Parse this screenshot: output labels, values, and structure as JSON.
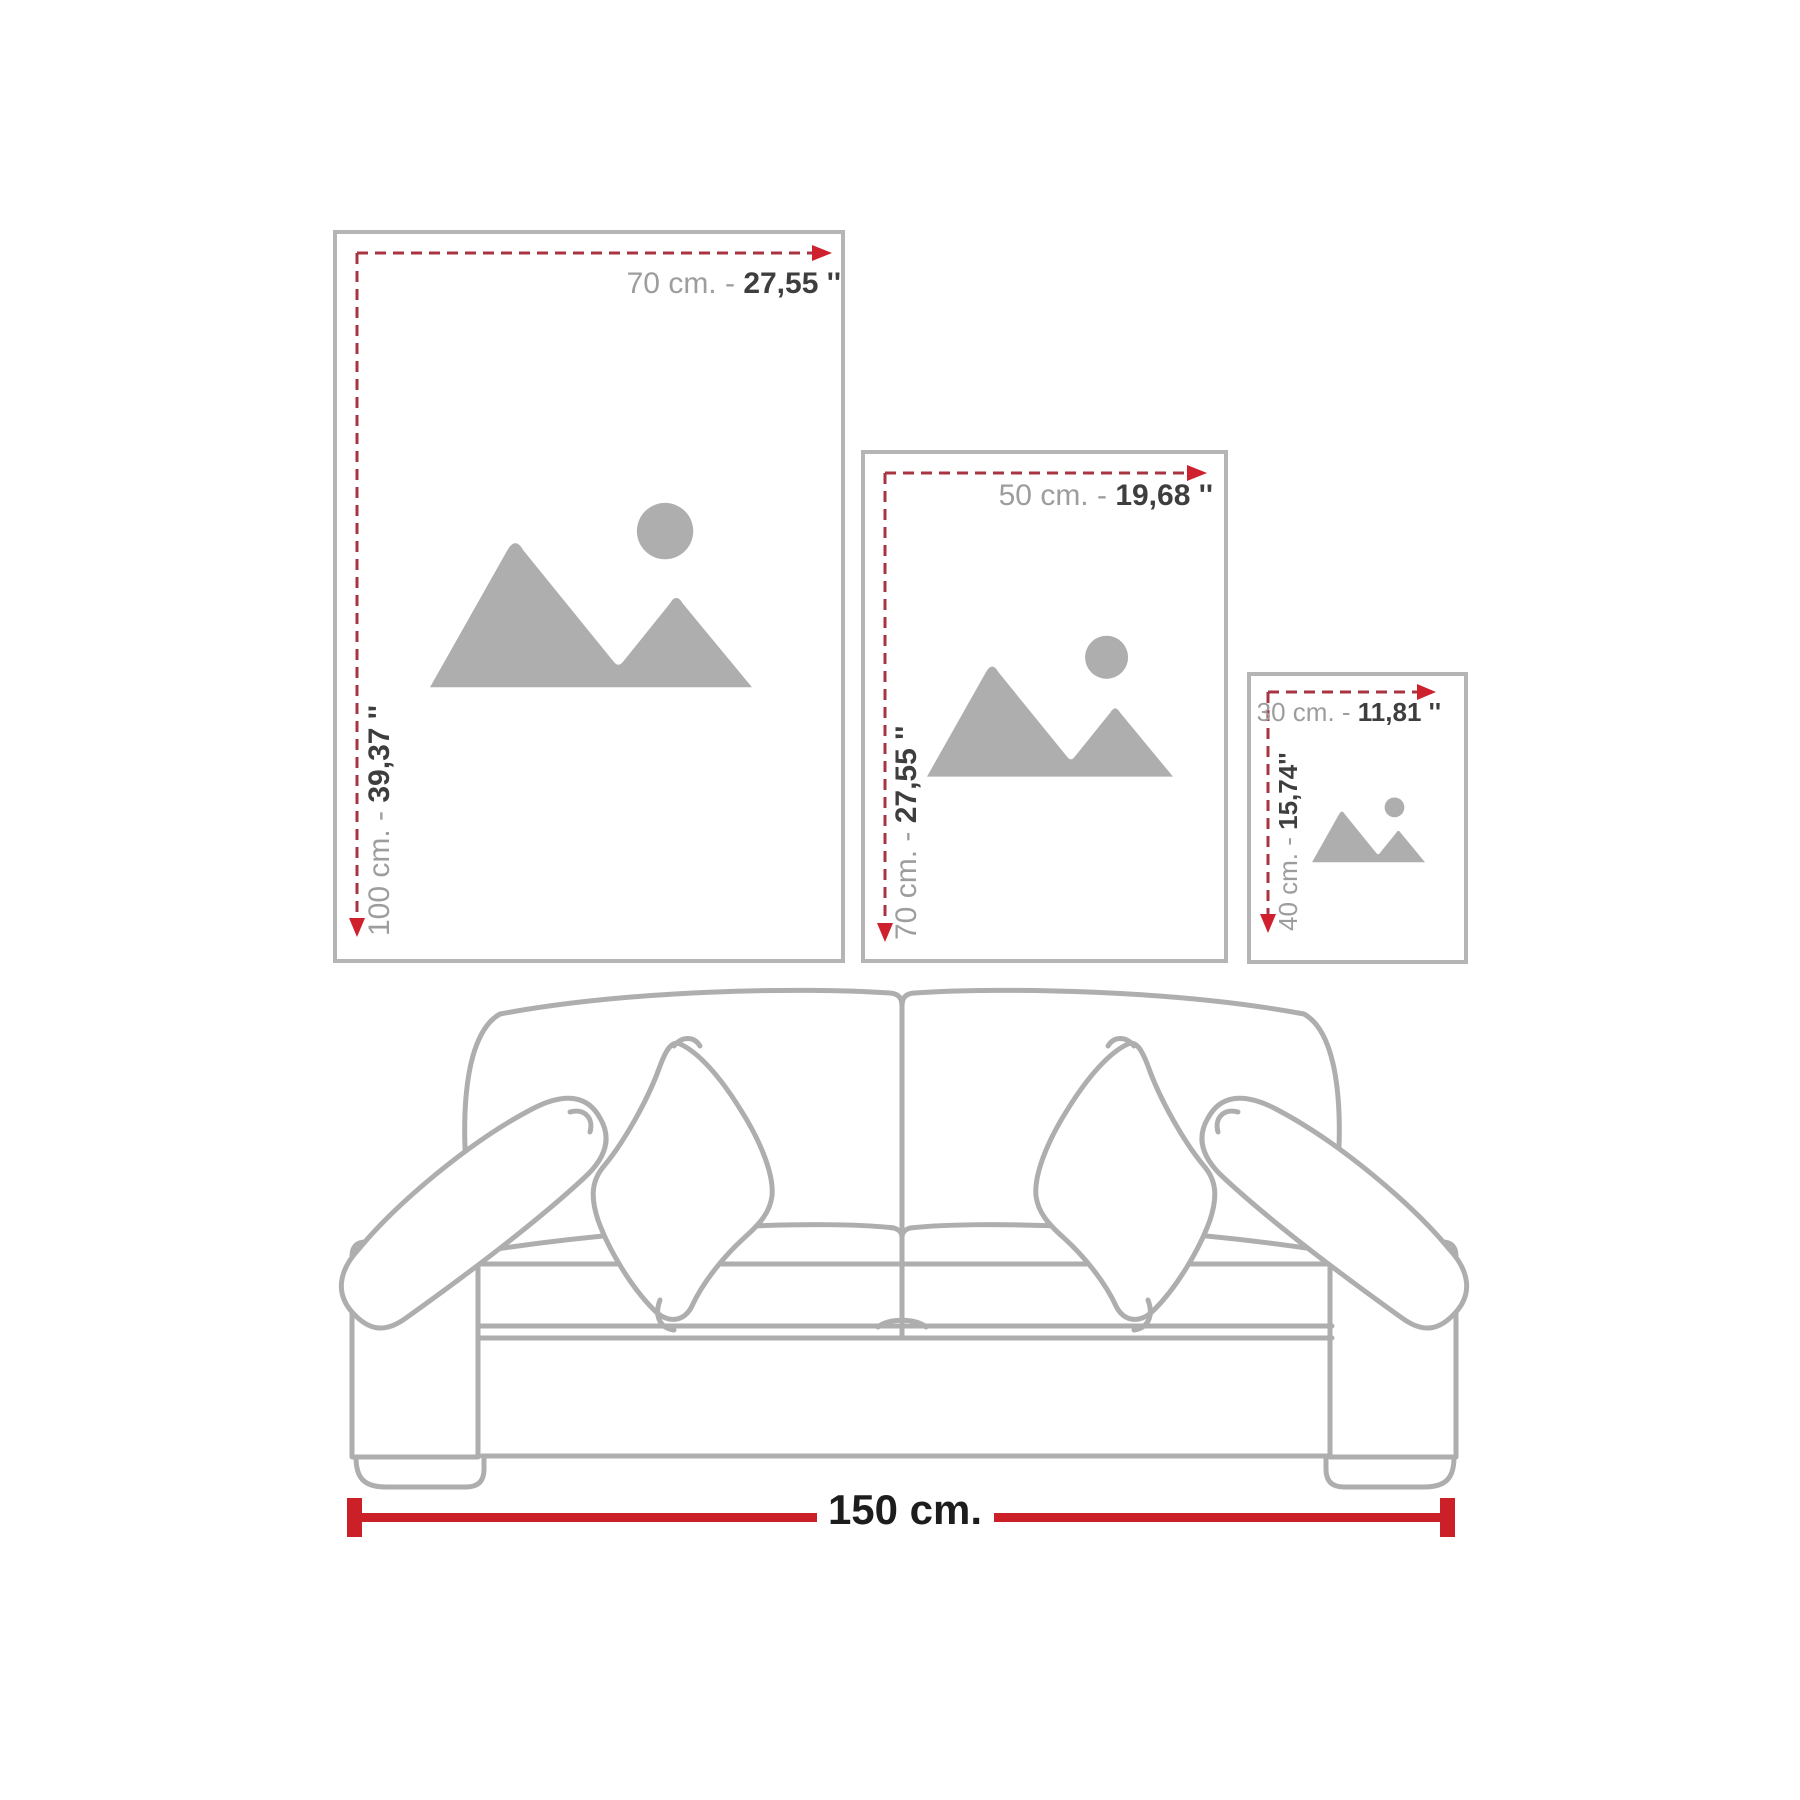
{
  "title": "Wall art size comparison diagram",
  "colors": {
    "background": "#ffffff",
    "frame_border": "#b5b5b5",
    "placeholder_gray": "#aeaeae",
    "dash_red": "#a93441",
    "arrow_red": "#cf202e",
    "bar_red": "#cc2028",
    "label_gray": "#9d9d9d",
    "label_dark": "#3e3e3e",
    "sofa_line": "#aeaeae",
    "bottom_label_color": "#1d1d1d"
  },
  "icons": {
    "placeholder": "image-placeholder-icon",
    "width_arrow": "dashed-width-arrow-icon",
    "height_arrow": "dashed-height-arrow-icon"
  },
  "frames": [
    {
      "name": "frame-100x70",
      "w_gray": "70 cm. - ",
      "w_dark": "27,55 ''",
      "h_gray": "100 cm. - ",
      "h_dark": "39,37 ''"
    },
    {
      "name": "frame-70x50",
      "w_gray": "50 cm. - ",
      "w_dark": "19,68 ''",
      "h_gray": "70 cm. - ",
      "h_dark": "27,55 ''"
    },
    {
      "name": "frame-40x30",
      "w_gray": "30 cm. - ",
      "w_dark": "11,81 ''",
      "h_gray": "40 cm. - ",
      "h_dark": "15,74''"
    }
  ],
  "sofa": {
    "width_label": "150 cm."
  }
}
